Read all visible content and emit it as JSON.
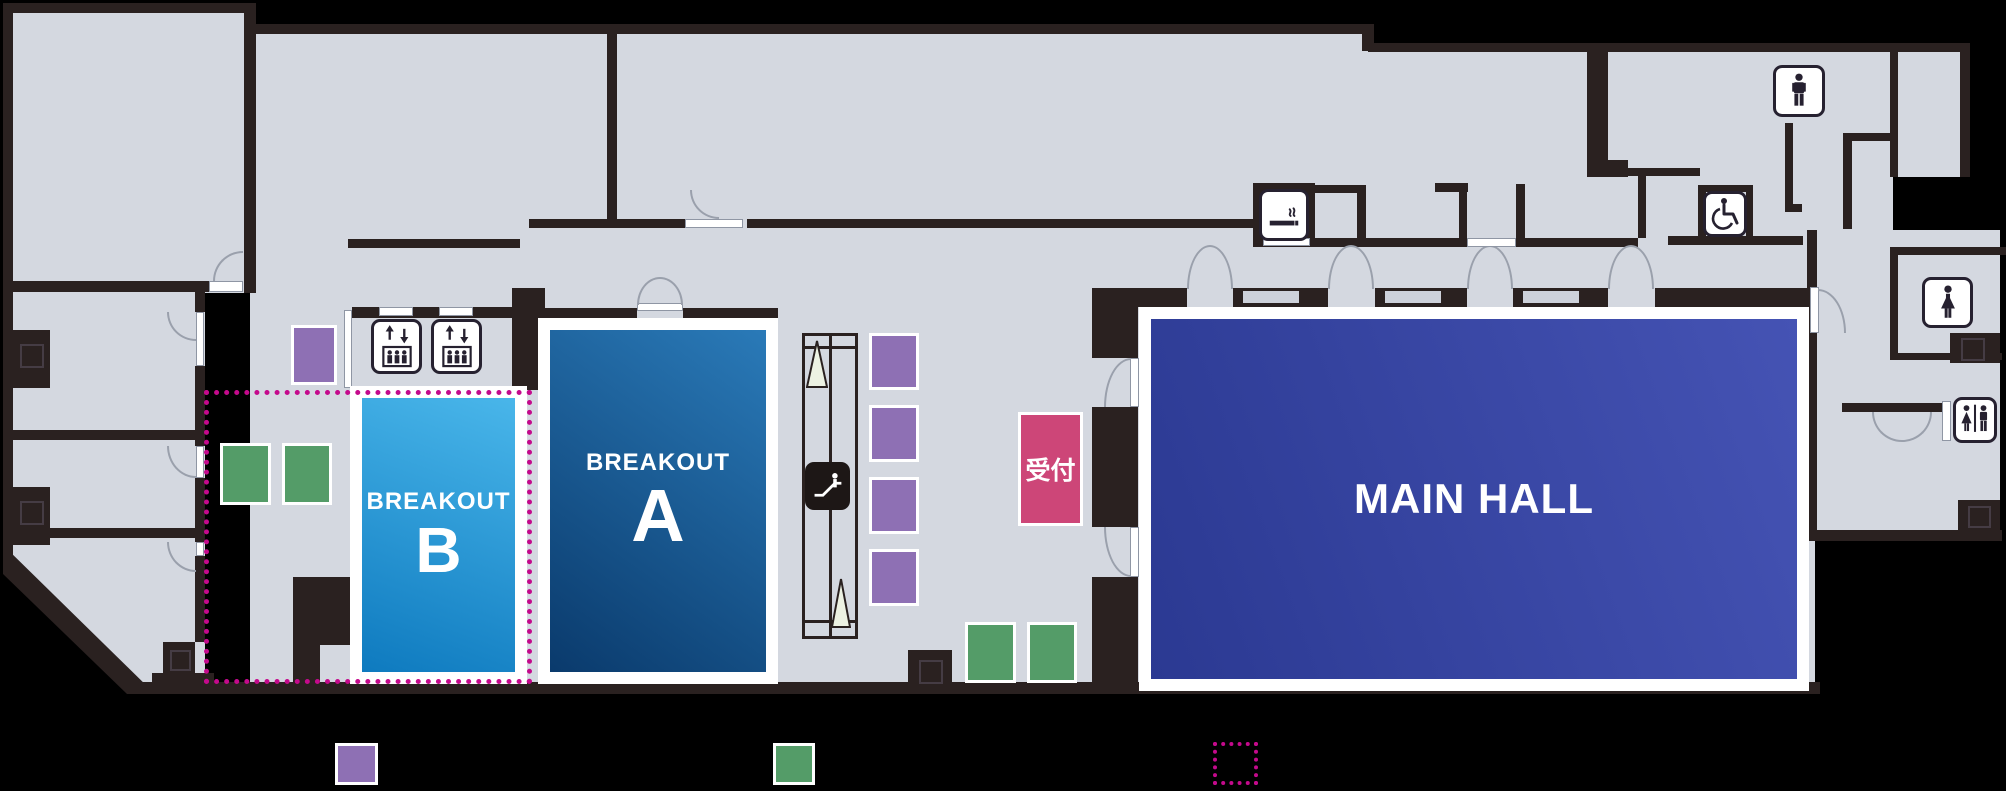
{
  "map": {
    "title": "event-venue-floor-map",
    "rooms": {
      "breakout_a": {
        "name": "BREAKOUT",
        "letter": "A"
      },
      "breakout_b": {
        "name": "BREAKOUT",
        "letter": "B"
      },
      "main_hall": {
        "name": "MAIN HALL"
      },
      "reception": {
        "name": "受付"
      }
    },
    "icons": [
      "elevator-icon",
      "elevator-icon",
      "escalator-icon",
      "smoking-area-icon",
      "wheelchair-accessible-icon",
      "mens-restroom-icon",
      "womens-restroom-icon",
      "unisex-restroom-icon"
    ],
    "legend": {
      "items": [
        {
          "name": "purple-zone-swatch",
          "style": "solid",
          "color": "#8e70b4"
        },
        {
          "name": "green-zone-swatch",
          "style": "solid",
          "color": "#549c68"
        },
        {
          "name": "magenta-highlight-swatch",
          "style": "dotted-outline",
          "color": "#c40a8c"
        }
      ]
    },
    "colors": {
      "floor": "#d4d8e0",
      "wall": "#2a2120",
      "purple": "#8e70b4",
      "green": "#549c68",
      "magenta": "#c40a8c",
      "reception": "#cd4678",
      "breakout_a_light": "#2a7ab8",
      "breakout_a_dark": "#0a3a6c",
      "breakout_b_light": "#49b6ea",
      "breakout_b_dark": "#0e7abf",
      "main_hall_light": "#4553b4",
      "main_hall_dark": "#2b3992"
    }
  }
}
